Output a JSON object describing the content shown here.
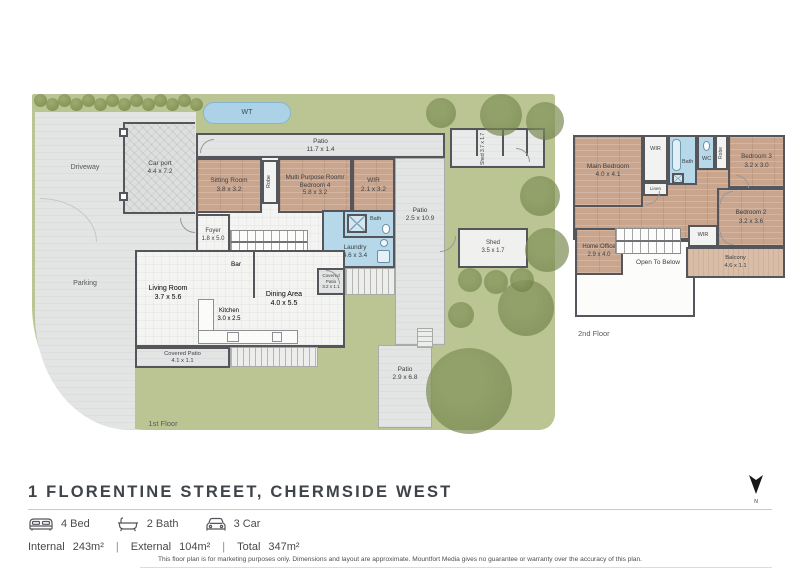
{
  "header": {
    "title": "1 FLORENTINE STREET, CHERMSIDE WEST",
    "compass_label": "N"
  },
  "summary": {
    "beds": "4 Bed",
    "baths": "2 Bath",
    "cars": "3 Car"
  },
  "areas": {
    "internal_label": "Internal",
    "internal_value": "243m²",
    "external_label": "External",
    "external_value": "104m²",
    "total_label": "Total",
    "total_value": "347m²",
    "separator": "|"
  },
  "disclaimer": "This floor plan is for marketing purposes only. Dimensions and layout are approximate. Mountfort Media gives no guarantee or warranty over the accuracy of this plan.",
  "floor1": {
    "label": "1st Floor",
    "site": {
      "driveway": "Driveway",
      "parking": "Parking",
      "water_tank": "WT"
    },
    "rooms": {
      "carport": {
        "name": "Car port",
        "dims": "4.4 x 7.2"
      },
      "patio_top": {
        "name": "Patio",
        "dims": "11.7 x 1.4"
      },
      "sitting": {
        "name": "Sitting Room",
        "dims": "3.8 x 3.2"
      },
      "robe": {
        "name": "Robe"
      },
      "multi": {
        "name": "Multi Purpose Room/",
        "name2": "Bedroom 4",
        "dims": "5.8 x 3.2"
      },
      "wir": {
        "name": "WIR",
        "dims": "2.1 x 3.2"
      },
      "patio_right": {
        "name": "Patio",
        "dims": "2.5 x 10.9"
      },
      "bath": {
        "name": "Bath"
      },
      "laundry": {
        "name": "Laundry",
        "dims": "4.6 x 3.4"
      },
      "foyer": {
        "name": "Foyer",
        "dims": "1.8 x 5.0"
      },
      "bar": {
        "name": "Bar"
      },
      "living": {
        "name": "Living Room",
        "dims": "3.7 x 5.6"
      },
      "dining": {
        "name": "Dining Area",
        "dims": "4.0 x 5.5"
      },
      "kitchen": {
        "name": "Kitchen",
        "dims": "3.0 x 2.5"
      },
      "covered_patio_left": {
        "name": "Covered Patio",
        "dims": "4.1 x 1.1"
      },
      "covered_patio_right": {
        "name": "Covered Patio",
        "dims": "3.2 x 1.1"
      },
      "shed_top": {
        "name": "Shed",
        "dims": "3.7 x 1.7"
      },
      "shed_mid": {
        "name": "Shed",
        "dims": "3.5 x 1.7"
      },
      "patio_bottom": {
        "name": "Patio",
        "dims": "2.9 x 6.8"
      }
    }
  },
  "floor2": {
    "label": "2nd Floor",
    "rooms": {
      "main_bedroom": {
        "name": "Main Bedroom",
        "dims": "4.0 x 4.1"
      },
      "wir_top": {
        "name": "WIR"
      },
      "linen": {
        "name": "Linen"
      },
      "bath": {
        "name": "Bath"
      },
      "wc": {
        "name": "WC"
      },
      "robe": {
        "name": "Robe"
      },
      "bedroom3": {
        "name": "Bedroom 3",
        "dims": "3.2 x 3.0"
      },
      "bedroom2": {
        "name": "Bedroom 2",
        "dims": "3.2 x 3.6"
      },
      "wir_bed2": {
        "name": "WIR"
      },
      "home_office": {
        "name": "Home Office",
        "dims": "2.9 x 4.0"
      },
      "open_below": {
        "name": "Open To Below"
      },
      "balcony": {
        "name": "Balcony",
        "dims": "4.6 x 1.1"
      }
    }
  },
  "colors": {
    "grass": "#bac593",
    "wood": "#c9a58d",
    "wet": "#b6d8e8",
    "wall": "#54565c",
    "paving": "#e3e5e4"
  }
}
